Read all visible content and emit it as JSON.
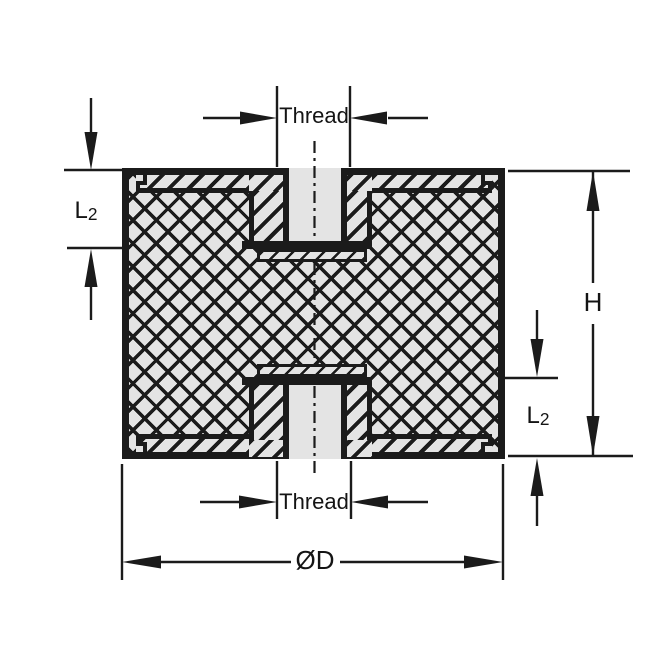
{
  "drawing": {
    "kind": "cross-section of cylindrical rubber mount with threaded inserts",
    "labels": {
      "thread_top": "Thread",
      "thread_bottom": "Thread",
      "l2_left": {
        "base": "L",
        "sub": "2"
      },
      "l2_right": {
        "base": "L",
        "sub": "2"
      },
      "height": "H",
      "diameter": "ØD"
    },
    "colors": {
      "line": "#1b1b1b",
      "section_fill": "#e4e4e4",
      "background": "#ffffff"
    }
  }
}
